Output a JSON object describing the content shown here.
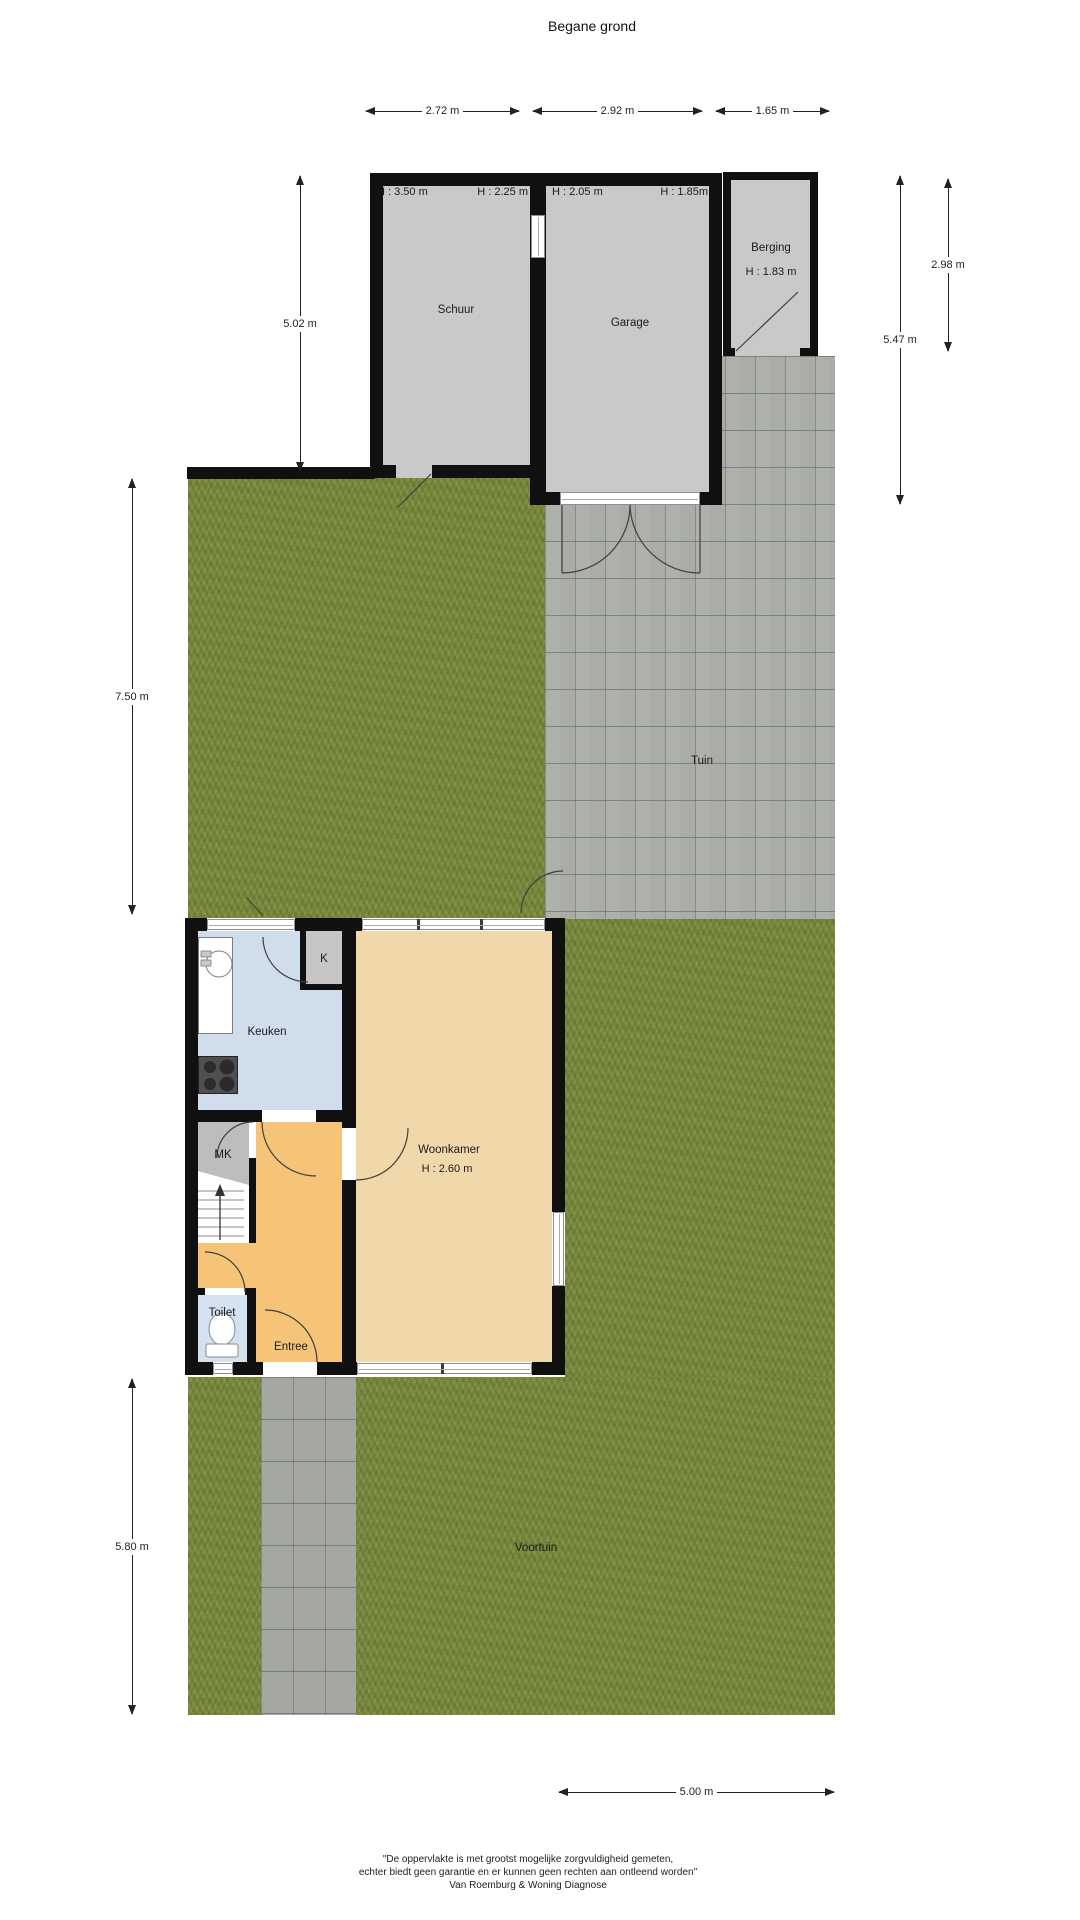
{
  "title": "Begane grond",
  "dimensions": {
    "top": [
      "2.72 m",
      "2.92 m",
      "1.65 m"
    ],
    "left": [
      "5.02 m",
      "7.50 m",
      "5.80 m"
    ],
    "right": [
      "5.47 m",
      "2.98 m"
    ],
    "bottom": [
      "5.00 m"
    ]
  },
  "rooms": {
    "schuur": {
      "label": "Schuur",
      "height_left": "H : 3.50 m",
      "height_right": "H : 2.25 m"
    },
    "garage": {
      "label": "Garage",
      "height_left": "H : 2.05 m",
      "height_right": "H : 1.85m"
    },
    "berging": {
      "label": "Berging",
      "height": "H : 1.83 m"
    },
    "tuin": {
      "label": "Tuin"
    },
    "keuken": {
      "label": "Keuken"
    },
    "kast": {
      "label": "K"
    },
    "meterkast": {
      "label": "MK"
    },
    "woonkamer": {
      "label": "Woonkamer",
      "height": "H : 2.60 m"
    },
    "toilet": {
      "label": "Toilet"
    },
    "entree": {
      "label": "Entree"
    },
    "voortuin": {
      "label": "Voortuin"
    }
  },
  "footer": {
    "line1": "\"De oppervlakte is met grootst mogelijke zorgvuldigheid gemeten,",
    "line2": "echter biedt geen garantie en er kunnen geen rechten aan ontleend worden\"",
    "line3": "Van Roemburg & Woning Diagnose"
  },
  "colors": {
    "wall": "#111111",
    "outbuilding_floor": "#c9c9c9",
    "grass": "#7b8a41",
    "paving": "#a9aca7",
    "keuken_floor": "#cfdeea",
    "woonkamer_floor": "#f1d8ab",
    "entree_floor": "#f6c478",
    "toilet_floor": "#d3e2ee"
  }
}
